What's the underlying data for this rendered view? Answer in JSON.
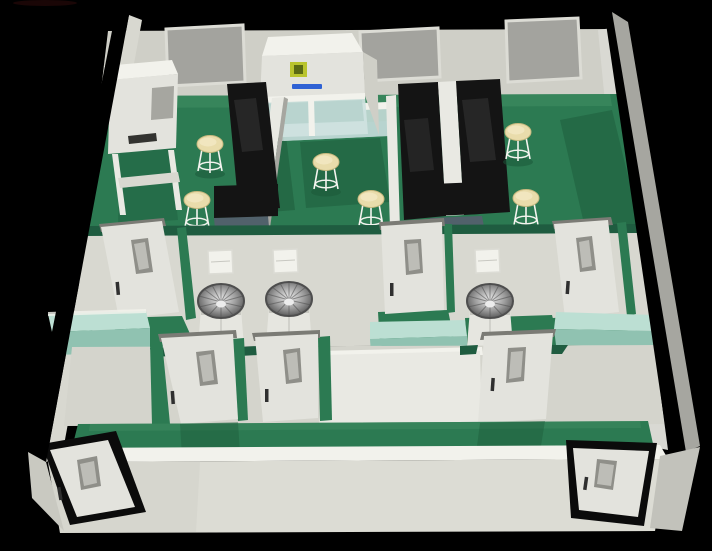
{
  "scene": {
    "description": "3D cutaway render of a cleanroom laboratory suite viewed from above, on a black background",
    "room_count": 3,
    "stool_count": 6,
    "scrub_sink_count": 3,
    "interior_door_count": 6,
    "entry_door_count": 2,
    "pass_box_count": 3,
    "counter_count": 3,
    "wall_board_count": 3,
    "equipment": [
      "biosafety-cabinet",
      "fume-hood",
      "lab-bench-black",
      "wall-board",
      "scrub-sink",
      "mint-counter",
      "lab-stool",
      "pass-box",
      "glass-partition"
    ],
    "brand_mark": {
      "logo_square_color": "#b9c42e",
      "text_color": "#2f62d4",
      "text_legible": false
    }
  },
  "palette": {
    "bg": "#000000",
    "wallTop": "#ededе7",
    "wallFace": "#cfcfc7",
    "wallFace2": "#d8d8d0",
    "wallShade": "#a6a6a0",
    "wallInnerR": "#d9d9d3",
    "bright": "#f2f2ec",
    "floor": "#2c7a52",
    "floorDark": "#1b5738",
    "floorLight": "#3f8c62",
    "cap": "#1f5c40",
    "board": "#a3a39e",
    "boardFrame": "#dcdcd5",
    "bench": "#141414",
    "benchHi": "#2b2b2b",
    "steelBlue": "#51616b",
    "divider": "#e9e9e3",
    "stool": "#e9dcab",
    "stoolRim": "#c9b97f",
    "stoolShine": "#f3e9c4",
    "legWhite": "#f4f4ef",
    "mint": "#bcdfd3",
    "mintDark": "#90c2b1",
    "glass": "#cfe2df",
    "glassDeep": "#b9d4cf",
    "doorFace": "#e3e3dd",
    "doorHeader": "#7b7b75",
    "panelGrey": "#8f8f89",
    "panelInner": "#bdbdb7",
    "handle": "#2f2f2f",
    "frameBlack": "#0b0b0b",
    "pedestal": "#e6e6e0",
    "steelLight": "#ececec",
    "steelMid": "#9c9c9c",
    "steelDark": "#4e4e4e",
    "brandYellow": "#b9c42e",
    "brandYellowDark": "#5a6a14",
    "brandBlue": "#2f62d4"
  }
}
